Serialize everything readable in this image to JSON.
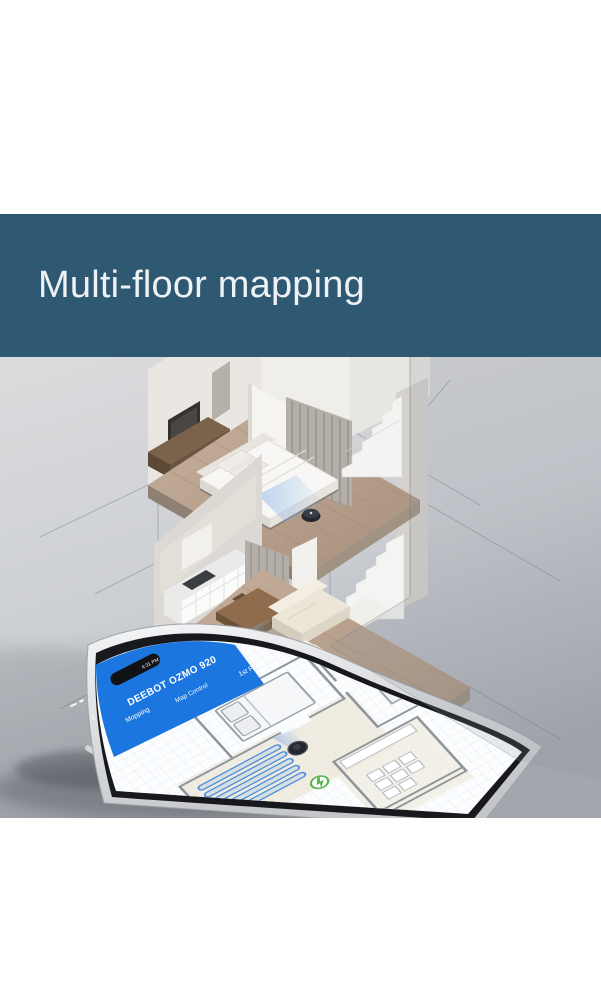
{
  "banner": {
    "title": "Multi-floor mapping",
    "bg_color": "#2f5872",
    "text_color": "#eef2f5"
  },
  "phone_app": {
    "status_time": "4:31 PM",
    "back_glyph": "‹",
    "title": "DEEBOT OZMO 920",
    "subtitle": "Map Control",
    "tab_left": "Mopping",
    "floor_selector": "1st Fl",
    "header_color": "#1b76e0",
    "icons": {
      "back": "back-chevron-icon",
      "signal": "signal-icon",
      "notch": "phone-notch",
      "robot": "robot-vacuum-icon",
      "dock": "charging-dock-icon"
    }
  },
  "map": {
    "mopping_strip_count": 5,
    "strip_color": "#4a8fd9",
    "robot_color": "#24272c",
    "dock_color": "#58b549",
    "wall_color": "#8f959d"
  },
  "scene_colors": {
    "background_top": "#d8dadc",
    "background_bottom": "#9ba0a7",
    "wood_floor": "#b49c88",
    "walls": "#eae7e2",
    "robot": "#24272c",
    "beam_blue": "#7fb0e8"
  }
}
